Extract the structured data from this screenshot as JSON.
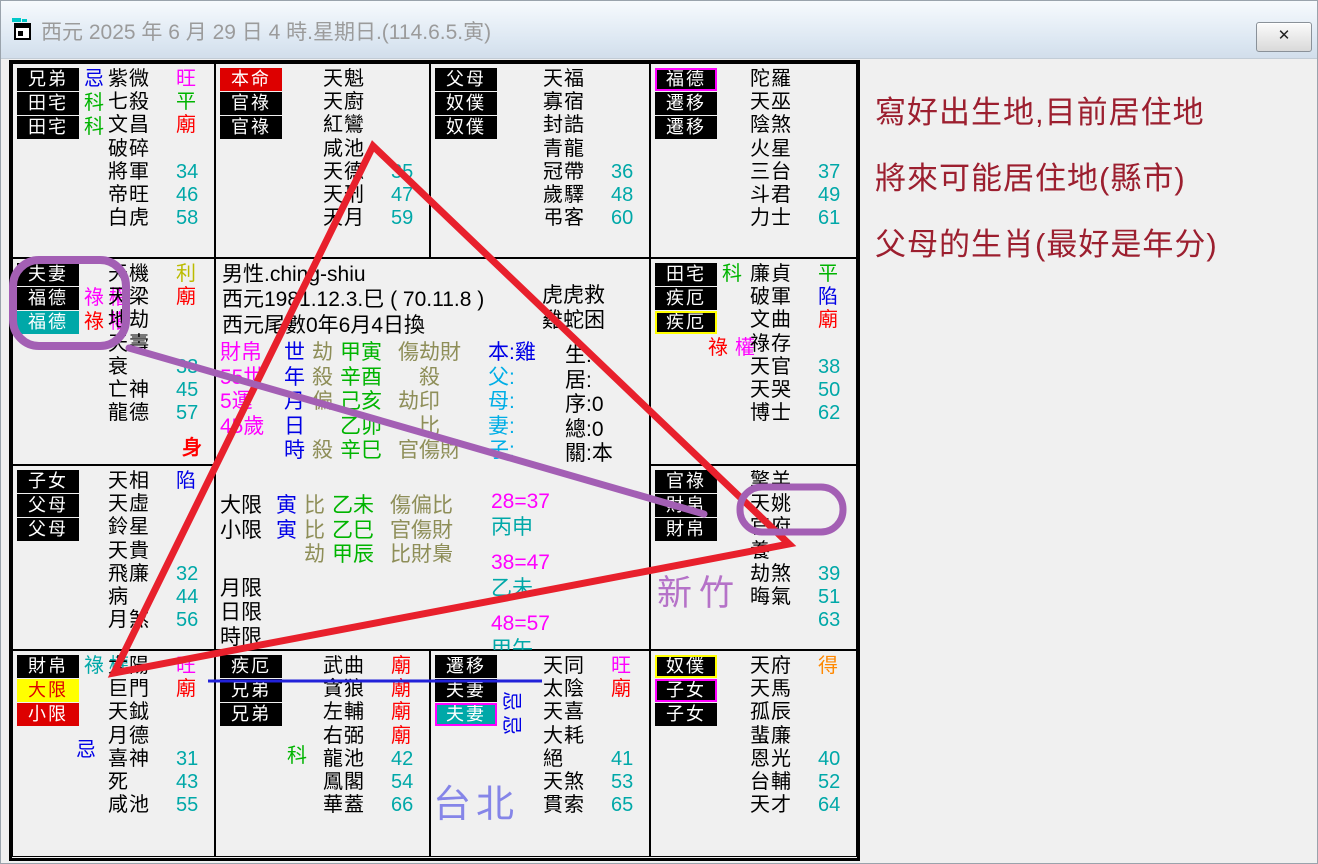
{
  "window": {
    "title": "西元 2025 年 6 月 29 日 4 時.星期日.(114.6.5.寅)",
    "close_glyph": "✕"
  },
  "colors": {
    "teal": "#00A8A8",
    "magenta": "#FF00FF",
    "green": "#00B400",
    "red": "#FF0000",
    "blue": "#0000E6",
    "olive": "#8E8E58",
    "gold": "#BE8A00",
    "status_yellow": "#C8C800",
    "cyan": "#00AEE6",
    "orange": "#FF8800",
    "label_red_bg": "#DD0000",
    "label_yellow_bg": "#FFFF00",
    "annotation_purple": "#A35FB4",
    "annotation_red": "#E8202C",
    "annotation_blue": "#2121D9",
    "note_dark_red": "#9C1F2F",
    "hsinchu_purple": "#B572C8",
    "taipei_blue": "#8585E8"
  },
  "palaces": [
    {
      "id": "r0c0",
      "pos": [
        0,
        0
      ],
      "labels": [
        {
          "t": "兄弟",
          "bg": "#000000"
        },
        {
          "t": "田宅",
          "bg": "#000000"
        },
        {
          "t": "田宅",
          "bg": "#000000"
        }
      ],
      "side": [
        [
          {
            "t": "忌",
            "c": "#0000E6"
          }
        ],
        [
          {
            "t": "科",
            "c": "#00B400"
          }
        ],
        [
          {
            "t": "科",
            "c": "#00B400"
          }
        ]
      ],
      "stars": [
        {
          "n": "紫微",
          "m": "旺",
          "mc": "#FF00FF"
        },
        {
          "n": "七殺",
          "m": "平",
          "mc": "#00B400"
        },
        {
          "n": "文昌",
          "m": "廟",
          "mc": "#FF0000"
        },
        {
          "n": "破碎"
        },
        {
          "n": "將軍",
          "m": "34",
          "mc": "#00A8A8"
        },
        {
          "n": "帝旺",
          "m": "46",
          "mc": "#00A8A8"
        },
        {
          "n": "白虎",
          "m": "58",
          "mc": "#00A8A8"
        }
      ]
    },
    {
      "id": "r0c1",
      "pos": [
        1,
        0
      ],
      "labels": [
        {
          "t": "本命",
          "bg": "#DD0000"
        },
        {
          "t": "官祿",
          "bg": "#000000"
        },
        {
          "t": "官祿",
          "bg": "#000000"
        }
      ],
      "stars": [
        {
          "n": "天魁"
        },
        {
          "n": "天廚"
        },
        {
          "n": "紅鸞"
        },
        {
          "n": "咸池"
        },
        {
          "n": "天德",
          "m": "35",
          "mc": "#00A8A8"
        },
        {
          "n": "天刑",
          "m": "47",
          "mc": "#00A8A8"
        },
        {
          "n": "天月",
          "m": "59",
          "mc": "#00A8A8"
        }
      ]
    },
    {
      "id": "r0c2",
      "pos": [
        2,
        0
      ],
      "labels": [
        {
          "t": "父母",
          "bg": "#000000"
        },
        {
          "t": "奴僕",
          "bg": "#000000"
        },
        {
          "t": "奴僕",
          "bg": "#000000"
        }
      ],
      "stars": [
        {
          "n": "天福"
        },
        {
          "n": "寡宿"
        },
        {
          "n": "封誥"
        },
        {
          "n": "青龍"
        },
        {
          "n": "冠帶",
          "m": "36",
          "mc": "#00A8A8"
        },
        {
          "n": "歲驛",
          "m": "48",
          "mc": "#00A8A8"
        },
        {
          "n": "弔客",
          "m": "60",
          "mc": "#00A8A8"
        }
      ]
    },
    {
      "id": "r0c3",
      "pos": [
        3,
        0
      ],
      "labels": [
        {
          "t": "福德",
          "bg": "#000000",
          "bd": "#FF00FF"
        },
        {
          "t": "遷移",
          "bg": "#000000"
        },
        {
          "t": "遷移",
          "bg": "#000000"
        }
      ],
      "stars": [
        {
          "n": "陀羅"
        },
        {
          "n": "天巫"
        },
        {
          "n": "陰煞"
        },
        {
          "n": "火星"
        },
        {
          "n": "三台",
          "m": "37",
          "mc": "#00A8A8"
        },
        {
          "n": "斗君",
          "m": "49",
          "mc": "#00A8A8"
        },
        {
          "n": "力士",
          "m": "61",
          "mc": "#00A8A8"
        }
      ]
    },
    {
      "id": "r1c0",
      "pos": [
        0,
        1
      ],
      "labels": [
        {
          "t": "夫妻",
          "bg": "#000000"
        },
        {
          "t": "福德",
          "bg": "#000000"
        },
        {
          "t": "福德",
          "bg": "#00A8A8"
        }
      ],
      "side": [
        [],
        [
          {
            "t": "祿",
            "c": "#FF00FF"
          },
          {
            "t": "權",
            "c": "#FF00FF"
          }
        ],
        [
          {
            "t": "祿",
            "c": "#FF0000"
          },
          {
            "t": "權",
            "c": "#FF00FF"
          }
        ]
      ],
      "stars": [
        {
          "n": "天機",
          "m": "利",
          "mc": "#BBBB00"
        },
        {
          "n": "天梁",
          "m": "廟",
          "mc": "#FF0000"
        },
        {
          "n": "地劫"
        },
        {
          "n": "天壽"
        },
        {
          "n": "衰",
          "m": "33",
          "mc": "#00A8A8"
        },
        {
          "n": "亡神",
          "m": "45",
          "mc": "#00A8A8"
        },
        {
          "n": "龍德",
          "m": "57",
          "mc": "#00A8A8"
        }
      ],
      "extra": {
        "t": "身",
        "c": "#FF0000"
      }
    },
    {
      "id": "r1c3",
      "pos": [
        3,
        1
      ],
      "labels": [
        {
          "t": "田宅",
          "bg": "#000000"
        },
        {
          "t": "疾厄",
          "bg": "#000000"
        },
        {
          "t": "疾厄",
          "bg": "#000000",
          "bd": "#FFFF00"
        }
      ],
      "side": [
        [
          {
            "t": "科",
            "c": "#00B400"
          }
        ],
        [],
        []
      ],
      "below": {
        "x": 52,
        "y": 78,
        "parts": [
          {
            "t": "祿",
            "c": "#FF0000"
          },
          {
            "t": "權",
            "c": "#FF00FF"
          }
        ]
      },
      "stars": [
        {
          "n": "廉貞",
          "m": "平",
          "mc": "#00B400"
        },
        {
          "n": "破軍",
          "m": "陷",
          "mc": "#0000E6"
        },
        {
          "n": "文曲",
          "m": "廟",
          "mc": "#FF0000"
        },
        {
          "n": "祿存"
        },
        {
          "n": "天官",
          "m": "38",
          "mc": "#00A8A8"
        },
        {
          "n": "天哭",
          "m": "50",
          "mc": "#00A8A8"
        },
        {
          "n": "博士",
          "m": "62",
          "mc": "#00A8A8"
        }
      ]
    },
    {
      "id": "r2c0",
      "pos": [
        0,
        2
      ],
      "labels": [
        {
          "t": "子女",
          "bg": "#000000"
        },
        {
          "t": "父母",
          "bg": "#000000"
        },
        {
          "t": "父母",
          "bg": "#000000"
        }
      ],
      "stars": [
        {
          "n": "天相",
          "m": "陷",
          "mc": "#0000E6"
        },
        {
          "n": "天虛"
        },
        {
          "n": "鈴星"
        },
        {
          "n": "天貴"
        },
        {
          "n": "飛廉",
          "m": "32",
          "mc": "#00A8A8"
        },
        {
          "n": "病",
          "m": "44",
          "mc": "#00A8A8"
        },
        {
          "n": "月煞",
          "m": "56",
          "mc": "#00A8A8"
        }
      ]
    },
    {
      "id": "r2c3",
      "pos": [
        3,
        2
      ],
      "labels": [
        {
          "t": "官祿",
          "bg": "#000000"
        },
        {
          "t": "財帛",
          "bg": "#000000"
        },
        {
          "t": "財帛",
          "bg": "#000000"
        }
      ],
      "stars": [
        {
          "n": "擎羊"
        },
        {
          "n": "天姚"
        },
        {
          "n": "官府"
        },
        {
          "n": "養"
        },
        {
          "n": "劫煞",
          "m": "39",
          "mc": "#00A8A8"
        },
        {
          "n": "晦氣",
          "m": "51",
          "mc": "#00A8A8"
        },
        {
          "n": "",
          "m": "63",
          "mc": "#00A8A8"
        }
      ]
    },
    {
      "id": "r3c0",
      "pos": [
        0,
        3
      ],
      "labels": [
        {
          "t": "財帛",
          "bg": "#000000"
        },
        {
          "t": "大限",
          "bg": "#FFFF00",
          "fg": "#DD0000",
          "bd": "#FFFF00"
        },
        {
          "t": "小限",
          "bg": "#DD0000"
        }
      ],
      "side": [
        [
          {
            "t": "祿",
            "c": "#00A8A8"
          },
          {
            "t": "權",
            "c": "#00A8A8"
          }
        ],
        [],
        []
      ],
      "below": {
        "x": 58,
        "y": 88,
        "parts": [
          {
            "t": "忌",
            "c": "#0000E6"
          }
        ]
      },
      "stars": [
        {
          "n": "太陽",
          "m": "旺",
          "mc": "#FF00FF"
        },
        {
          "n": "巨門",
          "m": "廟",
          "mc": "#FF0000"
        },
        {
          "n": "天鉞"
        },
        {
          "n": "月德"
        },
        {
          "n": "喜神",
          "m": "31",
          "mc": "#00A8A8"
        },
        {
          "n": "死",
          "m": "43",
          "mc": "#00A8A8"
        },
        {
          "n": "咸池",
          "m": "55",
          "mc": "#00A8A8"
        }
      ]
    },
    {
      "id": "r3c1",
      "pos": [
        1,
        3
      ],
      "labels": [
        {
          "t": "疾厄",
          "bg": "#000000"
        },
        {
          "t": "兄弟",
          "bg": "#000000"
        },
        {
          "t": "兄弟",
          "bg": "#000000"
        }
      ],
      "below": {
        "x": 66,
        "y": 94,
        "parts": [
          {
            "t": "科",
            "c": "#00B400"
          }
        ]
      },
      "stars": [
        {
          "n": "武曲",
          "m": "廟",
          "mc": "#FF0000"
        },
        {
          "n": "貪狼",
          "m": "廟",
          "mc": "#FF0000"
        },
        {
          "n": "左輔",
          "m": "廟",
          "mc": "#FF0000"
        },
        {
          "n": "右弼",
          "m": "廟",
          "mc": "#FF0000"
        },
        {
          "n": "龍池",
          "m": "42",
          "mc": "#00A8A8"
        },
        {
          "n": "鳳閣",
          "m": "54",
          "mc": "#00A8A8"
        },
        {
          "n": "華蓋",
          "m": "66",
          "mc": "#00A8A8"
        }
      ]
    },
    {
      "id": "r3c2",
      "pos": [
        2,
        3
      ],
      "labels": [
        {
          "t": "遷移",
          "bg": "#000000"
        },
        {
          "t": "夫妻",
          "bg": "#000000"
        },
        {
          "t": "夫妻",
          "bg": "#00A8A8",
          "bd": "#FF00FF"
        }
      ],
      "below": {
        "x": 70,
        "y": 40,
        "rot": true,
        "parts": [
          {
            "t": "忌",
            "c": "#0000E6"
          },
          {
            "t": "忌",
            "c": "#0000E6"
          }
        ]
      },
      "stars": [
        {
          "n": "天同",
          "m": "旺",
          "mc": "#FF00FF"
        },
        {
          "n": "太陰",
          "m": "廟",
          "mc": "#FF0000"
        },
        {
          "n": "天喜"
        },
        {
          "n": "大耗"
        },
        {
          "n": "絕",
          "m": "41",
          "mc": "#00A8A8"
        },
        {
          "n": "天煞",
          "m": "53",
          "mc": "#00A8A8"
        },
        {
          "n": "貫索",
          "m": "65",
          "mc": "#00A8A8"
        }
      ]
    },
    {
      "id": "r3c3",
      "pos": [
        3,
        3
      ],
      "labels": [
        {
          "t": "奴僕",
          "bg": "#000000",
          "bd": "#FFFF00"
        },
        {
          "t": "子女",
          "bg": "#000000",
          "bd": "#FF00FF"
        },
        {
          "t": "子女",
          "bg": "#000000"
        }
      ],
      "stars": [
        {
          "n": "天府",
          "m": "得",
          "mc": "#FF8800"
        },
        {
          "n": "天馬"
        },
        {
          "n": "孤辰"
        },
        {
          "n": "蜚廉"
        },
        {
          "n": "恩光",
          "m": "40",
          "mc": "#00A8A8"
        },
        {
          "n": "台輔",
          "m": "52",
          "mc": "#00A8A8"
        },
        {
          "n": "天才",
          "m": "64",
          "mc": "#00A8A8"
        }
      ]
    }
  ],
  "center": {
    "info": [
      "男性.ching-shiu",
      "西元1981.12.3.巳 ( 70.11.8 )",
      "西元尾數0年6月4日換"
    ],
    "pillars": [
      {
        "label": "財帛",
        "key": "世",
        "pre": "劫",
        "gz": "甲寅",
        "post": "傷劫財"
      },
      {
        "label": "55世",
        "key": "年",
        "pre": "殺",
        "gz": "辛酉",
        "post": "　殺"
      },
      {
        "label": "5運",
        "key": "月",
        "pre": "偏",
        "gz": "己亥",
        "post": "劫印"
      },
      {
        "label": "45歲",
        "key": "日",
        "pre": "",
        "gz": "乙卯",
        "post": "　比"
      },
      {
        "label": "",
        "key": "時",
        "pre": "殺",
        "gz": "辛巳",
        "post": "官傷財"
      }
    ],
    "relations": [
      {
        "t": "本:雞",
        "c": "#0000E6"
      },
      {
        "t": "父:",
        "c": "#00AEE6"
      },
      {
        "t": "母:",
        "c": "#00AEE6"
      },
      {
        "t": "妻:",
        "c": "#00AEE6"
      },
      {
        "t": "子:",
        "c": "#00AEE6"
      }
    ],
    "fate_notes": [
      "虎虎救",
      "雞蛇困"
    ],
    "status": [
      "生:",
      "居:",
      "序:0",
      "總:0",
      "關:本"
    ],
    "limits": [
      {
        "label": "大限",
        "branch": "寅",
        "pre": "比",
        "gz": "乙未",
        "post": "傷偏比"
      },
      {
        "label": "小限",
        "branch": "寅",
        "pre": "比",
        "gz": "乙巳",
        "post": "官傷財"
      },
      {
        "label": "",
        "branch": "",
        "pre": "劫",
        "gz": "甲辰",
        "post": "比財梟"
      },
      {
        "label": "月限",
        "branch": "",
        "pre": "",
        "gz": "",
        "post": ""
      },
      {
        "label": "日限",
        "branch": "",
        "pre": "",
        "gz": "",
        "post": ""
      },
      {
        "label": "時限",
        "branch": "",
        "pre": "",
        "gz": "",
        "post": ""
      }
    ],
    "decades": [
      {
        "range": "28=37",
        "gz": "丙申"
      },
      {
        "range": "38=47",
        "gz": "乙未"
      },
      {
        "range": "48=57",
        "gz": "甲午"
      }
    ]
  },
  "annotations": {
    "right_note_lines": [
      "寫好出生地,目前居住地",
      "將來可能居住地(縣市)",
      "父母的生肖(最好是年分)"
    ],
    "hsinchu": "新竹",
    "taipei": "台北"
  }
}
